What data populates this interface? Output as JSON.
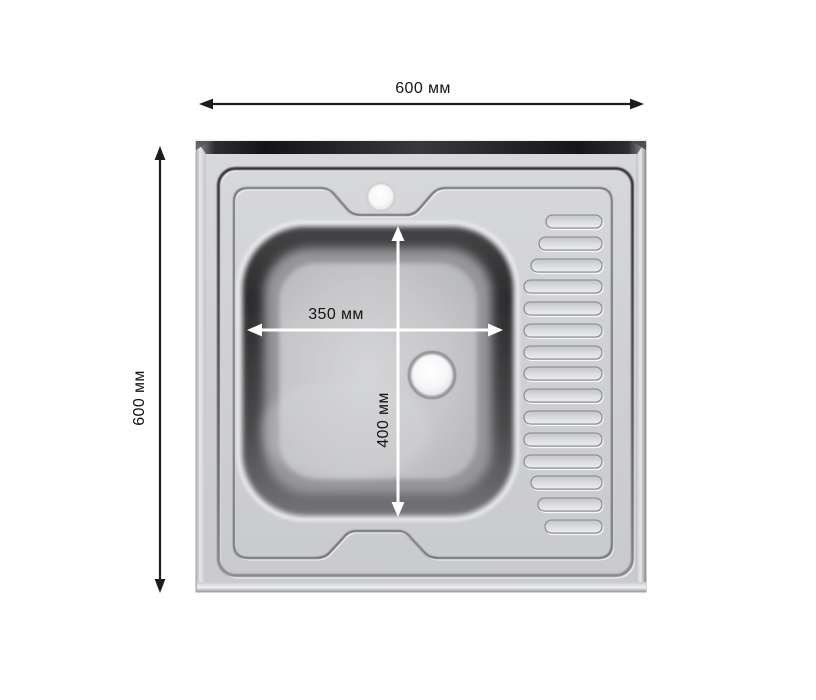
{
  "diagram": {
    "kind": "sink-dimension-drawing",
    "subject": "square stainless steel kitchen sink, top view, bowl left and drainboard right",
    "labels": {
      "overall_width": "600 мм",
      "overall_height": "600 мм",
      "bowl_width": "350 мм",
      "bowl_height": "400 мм"
    },
    "features": {
      "drainboard_rib_count": 15,
      "faucet_hole": "top center",
      "drain_hole": "right of bowl center"
    },
    "colors": {
      "page_background": "#ffffff",
      "outer_dimension_lines": "#1c1c1e",
      "inner_dimension_lines": "#ffffff",
      "label_text": "#141414",
      "sink_body": "#d0d1d3",
      "top_bevel_dark": "#1d1d1f",
      "bowl_rim_dark": "#2c2c2e",
      "bowl_interior": "#c6c7c9"
    }
  }
}
